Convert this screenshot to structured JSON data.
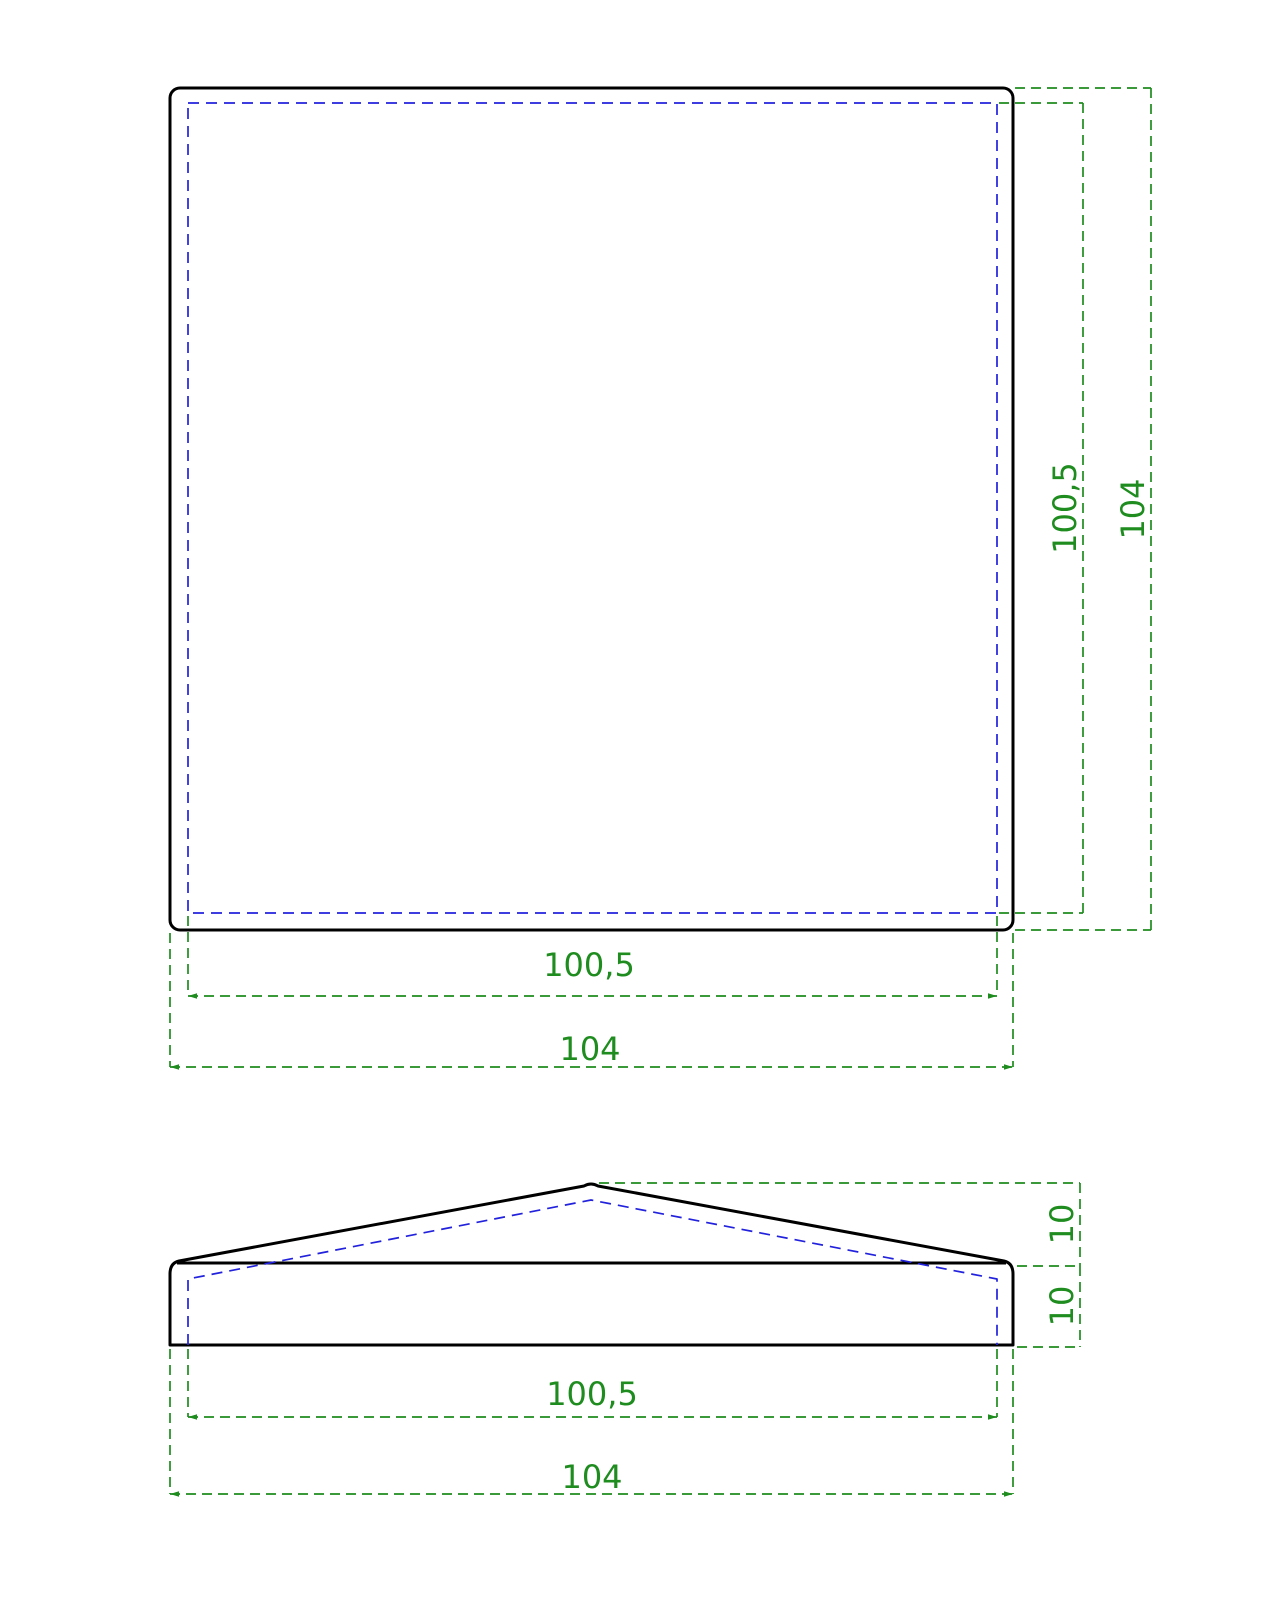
{
  "drawing": {
    "description": "Two-view technical drawing of a square pyramid post cap",
    "views": [
      "top view",
      "front view"
    ]
  },
  "colors": {
    "visible_edge": "#000000",
    "hidden_edge": "#2222dd",
    "dimension": "#1e8c1e",
    "background": "#ffffff"
  },
  "top_view": {
    "height_inner_label": "100,5",
    "height_outer_label": "104",
    "width_inner_label": "100,5",
    "width_outer_label": "104"
  },
  "front_view": {
    "roof_height_label": "10",
    "base_height_label": "10",
    "width_inner_label": "100,5",
    "width_outer_label": "104"
  }
}
